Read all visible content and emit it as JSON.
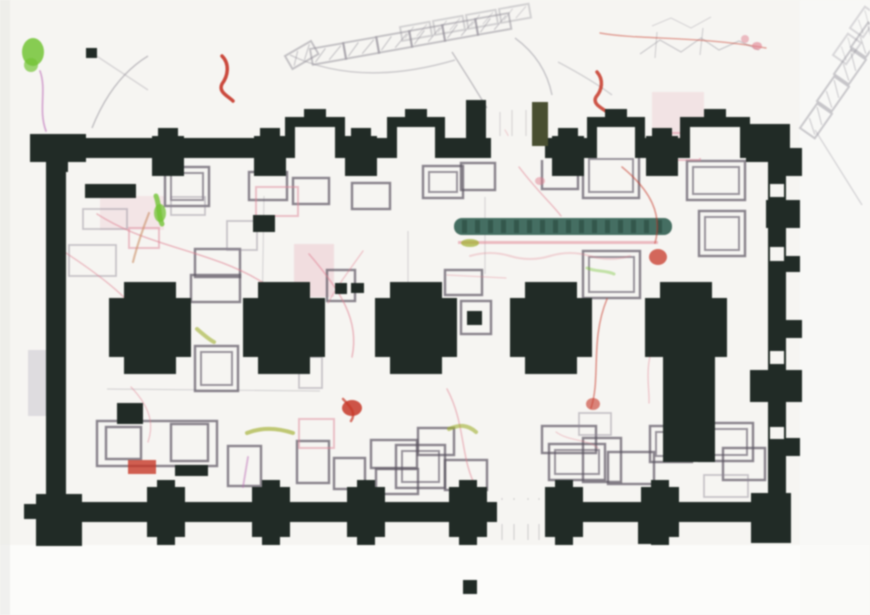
{
  "document": {
    "kind": "scanned-architectural-floor-plan",
    "description": "Scanned excavation drawing of a rectangular buttressed building with five cruciform pillars, grave outlines and colored survey annotations",
    "visible_text": []
  },
  "palette": {
    "paper": "#f5f4f1",
    "paper_bottom": "#fbfbf9",
    "paper_right": "#f8f8f6",
    "edge": "#e8e7e4",
    "wall": "#222c27",
    "grave": "#5a5260",
    "grave_faint": "#8d8694",
    "pinkrect": "#d9889a",
    "red": "#c0392b",
    "pink": "#dc8090",
    "tan": "#c8906a",
    "green": "#76c23c",
    "olive": "#9fae35",
    "teal": "#476e62",
    "teal_dark": "#33534a",
    "magenta": "#b66bb2",
    "sketch": "#8f8c96",
    "strip": "#c9c7cd",
    "jamb_olive": "#4a4f33"
  },
  "canvas": {
    "w": 870,
    "h": 615
  },
  "building": {
    "top_wall": {
      "x": 40,
      "y": 138,
      "w": 750,
      "h": 20,
      "gap": [
        491,
        54
      ]
    },
    "bottom_wall": {
      "x": 40,
      "y": 502,
      "w": 750,
      "h": 20,
      "gap": [
        497,
        48
      ]
    },
    "left_wall": [
      46,
      152,
      20,
      352
    ],
    "right_wall": [
      768,
      152,
      18,
      352
    ],
    "top_bays": [
      [
        285,
        345
      ],
      [
        387,
        445
      ],
      [
        587,
        645
      ],
      [
        680,
        750
      ]
    ],
    "top_piers": [
      168,
      270,
      361,
      568,
      662
    ],
    "bottom_piers": [
      166,
      271,
      366,
      468,
      564,
      660
    ],
    "corner_blocks": [
      [
        30,
        134,
        56,
        28
      ],
      [
        48,
        160,
        20,
        12
      ],
      [
        746,
        124,
        44,
        38
      ],
      [
        36,
        494,
        46,
        52
      ],
      [
        24,
        504,
        14,
        15
      ],
      [
        751,
        493,
        40,
        50
      ],
      [
        638,
        520,
        24,
        24
      ]
    ],
    "door_jambs": [
      {
        "r": [
          466,
          100,
          20,
          46
        ],
        "c": "wall"
      },
      {
        "r": [
          532,
          102,
          16,
          44
        ],
        "c": "jamb_olive"
      }
    ],
    "right_buttresses": [
      [
        784,
        148,
        18,
        28
      ],
      [
        766,
        200,
        34,
        28
      ],
      [
        784,
        256,
        16,
        16
      ],
      [
        784,
        320,
        18,
        18
      ],
      [
        750,
        370,
        52,
        32
      ],
      [
        784,
        438,
        16,
        18
      ]
    ],
    "right_notches": [
      [
        770,
        184,
        14,
        13
      ],
      [
        770,
        247,
        14,
        14
      ],
      [
        770,
        351,
        14,
        13
      ],
      [
        770,
        427,
        14,
        12
      ]
    ],
    "pillars": {
      "centers": [
        150,
        284,
        416,
        551,
        686
      ],
      "top": 282,
      "arm_half": 26,
      "full_half": 41,
      "arm_h": 17,
      "body_h": 59,
      "bot_arm_h": 18,
      "shaft_index": 4,
      "shaft": [
        663,
        340,
        52,
        122
      ]
    }
  },
  "graves": [
    [
      165,
      167,
      44,
      39,
      "d"
    ],
    [
      249,
      172,
      38,
      28,
      ""
    ],
    [
      293,
      178,
      36,
      26,
      ""
    ],
    [
      352,
      183,
      38,
      26,
      ""
    ],
    [
      423,
      166,
      40,
      32,
      "d"
    ],
    [
      461,
      163,
      34,
      27,
      ""
    ],
    [
      542,
      157,
      36,
      32,
      ""
    ],
    [
      583,
      153,
      56,
      45,
      "d"
    ],
    [
      687,
      161,
      58,
      39,
      "d"
    ],
    [
      699,
      211,
      46,
      45,
      "d"
    ],
    [
      83,
      209,
      44,
      20,
      "f"
    ],
    [
      171,
      197,
      34,
      18,
      "f"
    ],
    [
      69,
      245,
      47,
      31,
      "f"
    ],
    [
      195,
      249,
      45,
      28,
      ""
    ],
    [
      227,
      221,
      30,
      29,
      "f"
    ],
    [
      191,
      275,
      49,
      27,
      ""
    ],
    [
      327,
      270,
      28,
      31,
      ""
    ],
    [
      445,
      270,
      37,
      25,
      ""
    ],
    [
      583,
      251,
      57,
      47,
      "d"
    ],
    [
      461,
      301,
      30,
      33,
      ""
    ],
    [
      195,
      346,
      43,
      45,
      "d"
    ],
    [
      299,
      357,
      23,
      31,
      "f"
    ],
    [
      97,
      421,
      120,
      45,
      ""
    ],
    [
      106,
      427,
      35,
      32,
      ""
    ],
    [
      171,
      424,
      37,
      37,
      ""
    ],
    [
      228,
      446,
      33,
      40,
      ""
    ],
    [
      297,
      441,
      32,
      42,
      ""
    ],
    [
      334,
      458,
      31,
      31,
      ""
    ],
    [
      371,
      440,
      46,
      28,
      ""
    ],
    [
      376,
      469,
      42,
      25,
      ""
    ],
    [
      396,
      445,
      49,
      43,
      "d"
    ],
    [
      418,
      428,
      36,
      27,
      ""
    ],
    [
      445,
      460,
      42,
      30,
      ""
    ],
    [
      542,
      426,
      54,
      27,
      ""
    ],
    [
      549,
      444,
      56,
      36,
      "d"
    ],
    [
      583,
      438,
      38,
      44,
      ""
    ],
    [
      579,
      413,
      32,
      22,
      "f"
    ],
    [
      608,
      452,
      46,
      32,
      ""
    ],
    [
      650,
      426,
      42,
      36,
      "d"
    ],
    [
      699,
      423,
      54,
      38,
      "d"
    ],
    [
      723,
      448,
      42,
      32,
      ""
    ],
    [
      704,
      475,
      44,
      22,
      "f"
    ]
  ],
  "pink_rects": [
    [
      256,
      187,
      42,
      29
    ],
    [
      659,
      133,
      41,
      27
    ],
    [
      299,
      419,
      35,
      29
    ],
    [
      129,
      228,
      30,
      20
    ]
  ],
  "washes": [
    [
      294,
      244,
      40,
      53,
      0.22
    ],
    [
      652,
      92,
      52,
      48,
      0.16
    ],
    [
      100,
      196,
      64,
      34,
      0.14
    ]
  ],
  "black_fills": [
    [
      85,
      184,
      51,
      14
    ],
    [
      253,
      215,
      22,
      17
    ],
    [
      117,
      403,
      26,
      21
    ],
    [
      175,
      465,
      33,
      11
    ],
    [
      86,
      48,
      11,
      10
    ],
    [
      467,
      311,
      15,
      14
    ],
    [
      463,
      580,
      14,
      14
    ],
    [
      335,
      283,
      12,
      11
    ],
    [
      351,
      283,
      13,
      10
    ]
  ],
  "teal_beam": {
    "x": 454,
    "y": 218,
    "w": 218,
    "h": 17,
    "tick_step": 13,
    "underline": [
      458,
      241,
      200,
      3
    ]
  },
  "colored_lines": [
    {
      "d": "M222,56 C230,64 228,76 222,84 C218,92 228,96 233,101",
      "c": "red",
      "w": 3.5,
      "o": 0.9
    },
    {
      "d": "M597,72 C604,80 602,90 596,97 C592,104 602,108 607,112",
      "c": "red",
      "w": 3.5,
      "o": 0.85
    },
    {
      "d": "M600,33 C640,40 700,36 766,48",
      "c": "red",
      "w": 1.4,
      "o": 0.45
    },
    {
      "d": "M97,214 C150,248 210,250 262,282 C285,294 298,300 308,308",
      "c": "pink",
      "w": 1.6,
      "o": 0.5
    },
    {
      "d": "M63,251 C95,272 128,296 141,318",
      "c": "pink",
      "w": 1.5,
      "o": 0.45
    },
    {
      "d": "M149,213 C140,236 136,250 133,262",
      "c": "tan",
      "w": 2.2,
      "o": 0.6
    },
    {
      "d": "M309,254 C340,290 360,320 352,357",
      "c": "pink",
      "w": 1.6,
      "o": 0.5
    },
    {
      "d": "M363,251 C348,272 336,288 328,303",
      "c": "pink",
      "w": 1.4,
      "o": 0.4
    },
    {
      "d": "M519,167 C538,192 552,204 561,216",
      "c": "pink",
      "w": 1.5,
      "o": 0.45
    },
    {
      "d": "M622,167 C650,190 663,214 655,243",
      "c": "red",
      "w": 1.6,
      "o": 0.5
    },
    {
      "d": "M607,299 C590,340 601,378 591,408",
      "c": "red",
      "w": 1.6,
      "o": 0.5
    },
    {
      "d": "M447,389 C466,424 460,460 477,489",
      "c": "pink",
      "w": 1.6,
      "o": 0.45
    },
    {
      "d": "M131,387 C155,412 152,430 148,442",
      "c": "pink",
      "w": 1.4,
      "o": 0.4
    },
    {
      "d": "M659,329 C642,366 650,386 649,403",
      "c": "pink",
      "w": 1.4,
      "o": 0.4
    },
    {
      "d": "M40,71 C47,90 38,110 46,131",
      "c": "magenta",
      "w": 1.8,
      "o": 0.55
    },
    {
      "d": "M140,327 L143,352",
      "c": "magenta",
      "w": 2.2,
      "o": 0.5
    },
    {
      "d": "M248,457 L243,487",
      "c": "magenta",
      "w": 2,
      "o": 0.45
    },
    {
      "d": "M447,275 L506,278",
      "c": "pink",
      "w": 1.2,
      "o": 0.35
    },
    {
      "d": "M556,432 C570,442 585,438 598,448",
      "c": "pink",
      "w": 1.3,
      "o": 0.35
    },
    {
      "d": "M156,196 C160,206 158,216 162,224",
      "c": "green",
      "w": 5,
      "o": 0.8
    },
    {
      "d": "M197,329 C205,336 210,340 214,342",
      "c": "olive",
      "w": 4,
      "o": 0.6
    },
    {
      "d": "M247,433 C262,427 278,428 293,433",
      "c": "olive",
      "w": 4,
      "o": 0.65
    },
    {
      "d": "M449,429 C460,424 468,425 476,432",
      "c": "olive",
      "w": 4,
      "o": 0.6
    },
    {
      "d": "M587,268 C596,272 606,270 614,274",
      "c": "green",
      "w": 3,
      "o": 0.4
    },
    {
      "d": "M505,130 C512,140 510,150 516,158",
      "c": "pink",
      "w": 1.3,
      "o": 0.3
    },
    {
      "d": "M343,399 C352,408 356,414 351,421",
      "c": "red",
      "w": 2.5,
      "o": 0.7
    },
    {
      "d": "M470,256 q20,-6 40,0 t40,0 t40,0 t40,0",
      "c": "pink",
      "w": 2,
      "o": 0.3
    }
  ],
  "blobs": [
    [
      658,
      257,
      9,
      8,
      "red",
      0.75
    ],
    [
      352,
      408,
      10,
      8,
      "red",
      0.85
    ],
    [
      593,
      404,
      7,
      6,
      "red",
      0.6
    ],
    [
      757,
      46,
      5,
      4,
      "pink",
      0.6
    ],
    [
      745,
      39,
      4,
      4,
      "pink",
      0.5
    ],
    [
      540,
      181,
      5,
      4,
      "pink",
      0.5
    ],
    [
      33,
      52,
      11,
      14,
      "green",
      0.85
    ],
    [
      31,
      65,
      7,
      7,
      "green",
      0.7
    ],
    [
      160,
      213,
      6,
      9,
      "green",
      0.75
    ],
    [
      470,
      243,
      9,
      4,
      "olive",
      0.7
    ]
  ],
  "red_rect": [
    128,
    460,
    28,
    14
  ],
  "sketch_chains": [
    {
      "x": 310,
      "y": 49,
      "ang": -10,
      "n": 6,
      "dx": 33,
      "dy": -6,
      "w": 34,
      "h": 16,
      "o": 0.5
    },
    {
      "x": 400,
      "y": 27,
      "ang": -10,
      "n": 4,
      "dx": 33,
      "dy": -6,
      "w": 30,
      "h": 14,
      "o": 0.35
    },
    {
      "x": 285,
      "y": 56,
      "ang": -30,
      "n": 1,
      "dx": 0,
      "dy": 0,
      "w": 30,
      "h": 15,
      "o": 0.5
    },
    {
      "x": 800,
      "y": 128,
      "ang": -55,
      "n": 4,
      "dx": 17,
      "dy": -27,
      "w": 30,
      "h": 18,
      "o": 0.45
    },
    {
      "x": 833,
      "y": 55,
      "ang": -55,
      "n": 2,
      "dx": 17,
      "dy": -27,
      "w": 26,
      "h": 16,
      "o": 0.3
    }
  ],
  "scribbles": [
    {
      "d": "M640,54 L660,40 L681,52 L701,38 L719,50 L739,41 L759,50",
      "o": 0.4,
      "w": 1.3
    },
    {
      "d": "M652,26 L671,18 L691,28 L711,17",
      "o": 0.3,
      "w": 1.2
    },
    {
      "d": "M657,32 L655,58",
      "o": 0.35,
      "w": 1.2
    },
    {
      "d": "M703,28 L700,55",
      "o": 0.35,
      "w": 1.2
    }
  ],
  "curves": [
    {
      "d": "M92,128 Q112,78 148,56",
      "o": 0.5
    },
    {
      "d": "M290,55 Q360,88 455,60",
      "o": 0.4
    },
    {
      "d": "M452,52 Q470,80 487,108",
      "o": 0.5
    },
    {
      "d": "M515,38 Q545,60 552,95",
      "o": 0.45
    },
    {
      "d": "M558,62 Q592,80 612,95",
      "o": 0.35
    },
    {
      "d": "M815,130 Q840,170 862,205",
      "o": 0.3
    },
    {
      "d": "M95,55 L148,90",
      "o": 0.3
    }
  ],
  "faint_lines": [
    {
      "d": "M264,196 L262,320",
      "o": 0.3
    },
    {
      "d": "M485,197 L485,274",
      "o": 0.3
    },
    {
      "d": "M408,231 L408,301",
      "o": 0.3
    },
    {
      "d": "M107,389 L320,391",
      "o": 0.3
    },
    {
      "d": "M502,498 L502,540",
      "o": 0.35
    },
    {
      "d": "M514,498 L514,540",
      "o": 0.35
    },
    {
      "d": "M528,498 L528,540",
      "o": 0.35
    },
    {
      "d": "M539,498 L539,540",
      "o": 0.35
    },
    {
      "d": "M500,112 L500,138",
      "o": 0.3
    },
    {
      "d": "M512,110 L512,138",
      "o": 0.3
    },
    {
      "d": "M526,110 L526,138",
      "o": 0.3
    }
  ],
  "gray_strip": [
    28,
    350,
    20,
    66
  ]
}
